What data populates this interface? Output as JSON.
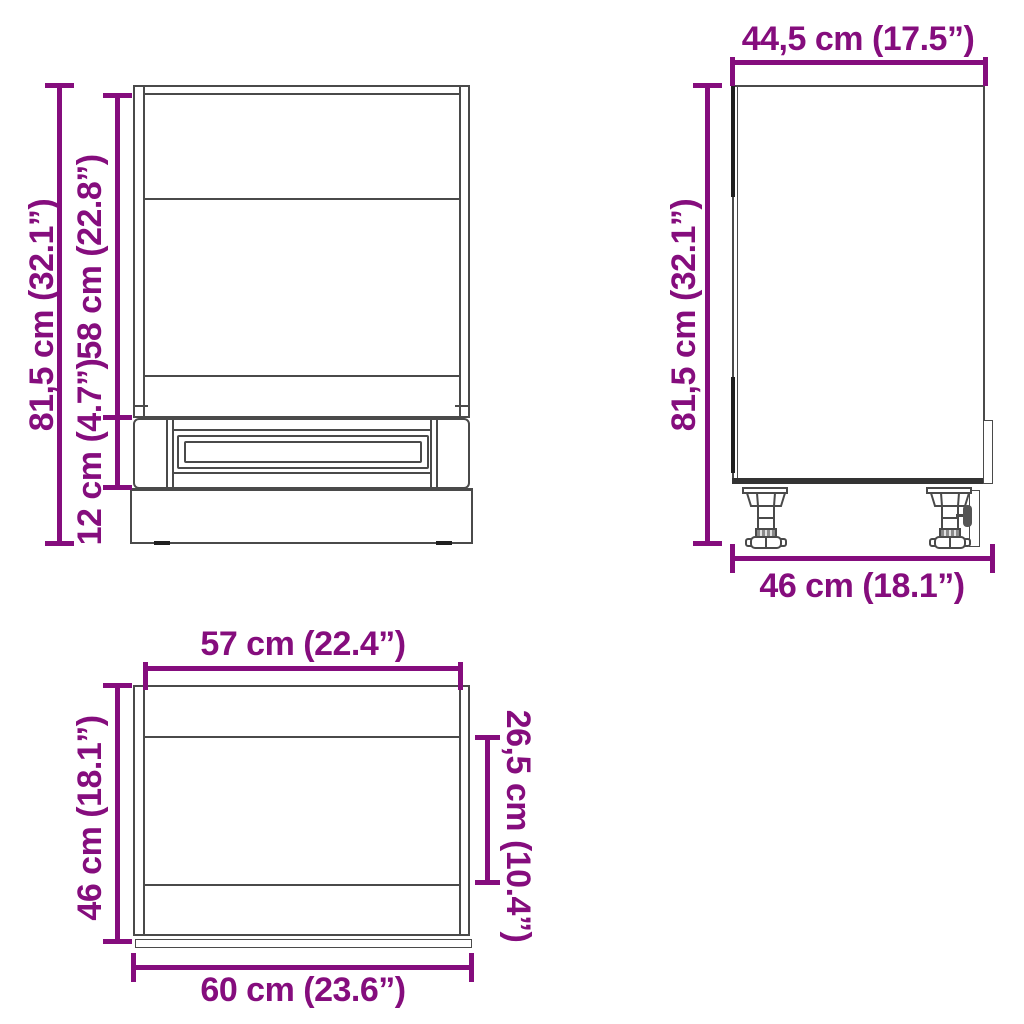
{
  "diagram": {
    "kind": "cabinet dimension drawing with three orthographic views",
    "colors": {
      "dimension_accent": "#850d7d",
      "drawing_line": "#4a4a4a",
      "background": "#ffffff"
    },
    "views": {
      "front": {
        "dimensions": {
          "total_height": "81,5 cm (32.1”)",
          "upper_section_height": "58 cm (22.8”)",
          "drawer_section_height": "12 cm (4.7”)"
        }
      },
      "side": {
        "dimensions": {
          "top_depth": "44,5 cm (17.5”)",
          "total_height": "81,5 cm (32.1”)",
          "base_depth": "46 cm (18.1”)"
        }
      },
      "top": {
        "dimensions": {
          "inner_width": "57 cm (22.4”)",
          "total_depth": "46 cm (18.1”)",
          "inner_depth": "26,5 cm (10.4”)",
          "outer_width": "60 cm (23.6”)"
        }
      }
    }
  }
}
